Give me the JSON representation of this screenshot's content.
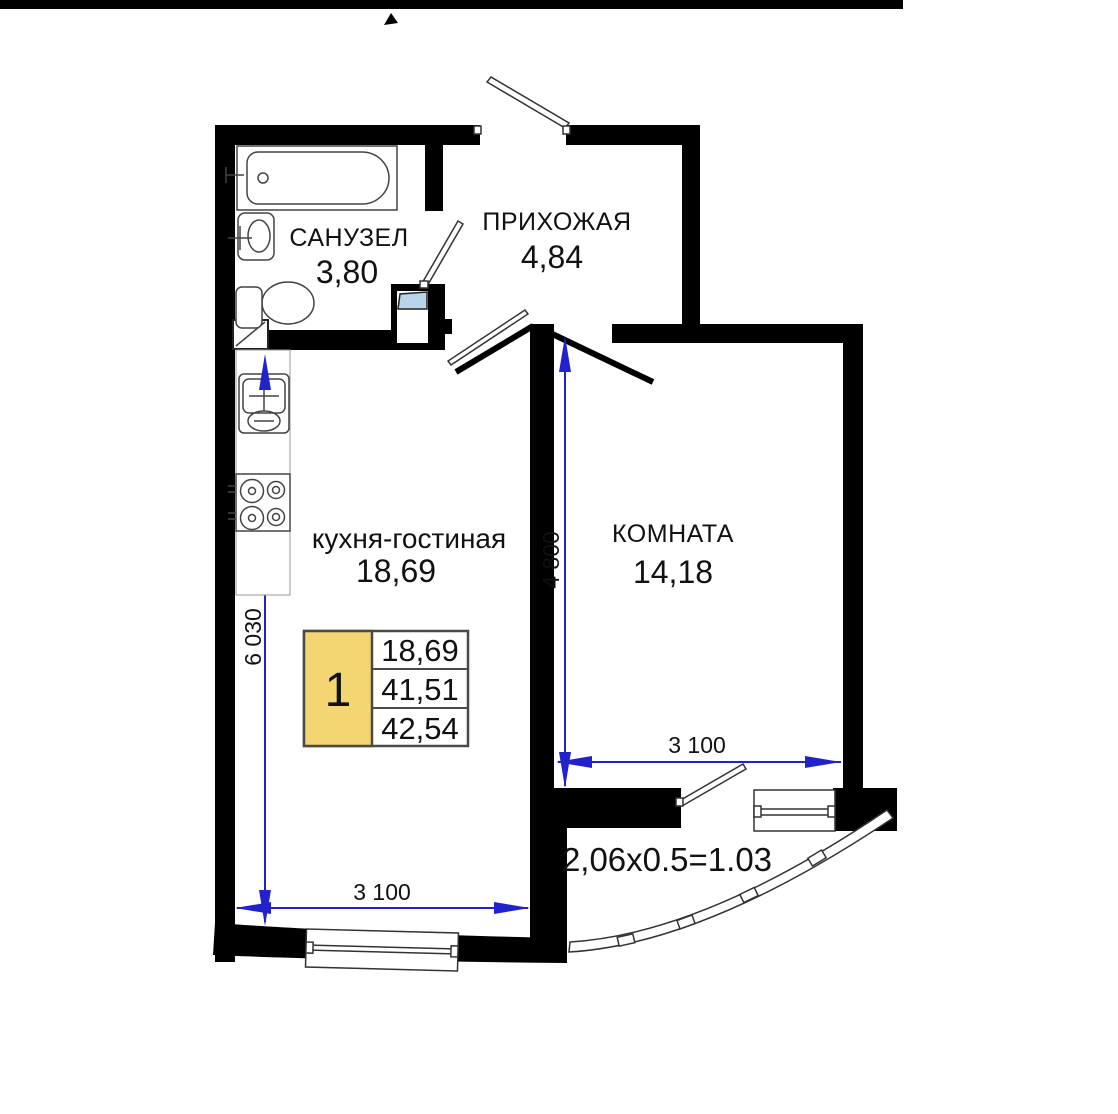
{
  "plan": {
    "type": "floor-plan",
    "rooms": {
      "bathroom": {
        "label": "САНУЗЕЛ",
        "area": "3,80"
      },
      "hallway": {
        "label": "ПРИХОЖАЯ",
        "area": "4,84"
      },
      "kitchen_living": {
        "label": "кухня-гостиная",
        "area": "18,69"
      },
      "room": {
        "label": "КОМНАТА",
        "area": "14,18"
      }
    },
    "balcony": {
      "area_formula": "2,06x0.5=1.03"
    },
    "dimensions": {
      "kitchen_height_mm": "6 030",
      "room_height_mm": "4 800",
      "room_width_mm": "3 100",
      "kitchen_width_mm": "3 100"
    },
    "legend": {
      "flat_number": "1",
      "rows": [
        "18,69",
        "41,51",
        "42,54"
      ]
    },
    "colors": {
      "wall": "#000000",
      "dimension": "#2222cc",
      "legend_fill": "#f3d671",
      "shaft_flap": "#b9d5e9"
    }
  }
}
